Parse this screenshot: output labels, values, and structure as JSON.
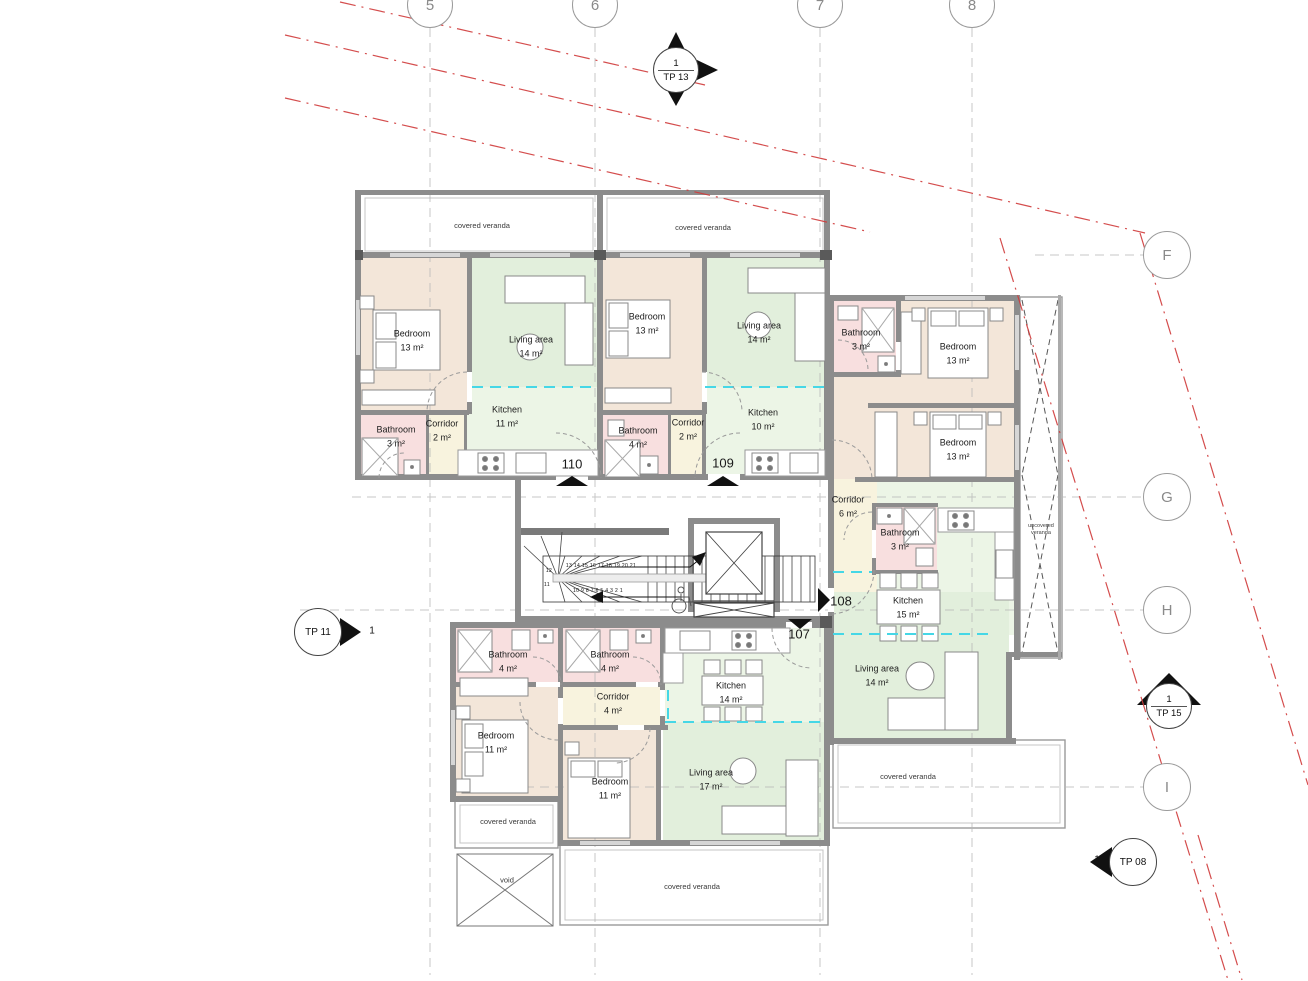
{
  "drawing": {
    "grid": {
      "columns": [
        "5",
        "6",
        "7",
        "8"
      ],
      "rows": [
        "F",
        "G",
        "H",
        "I"
      ]
    },
    "section_markers": {
      "tp13": {
        "number": "1",
        "label": "TP 13"
      },
      "tp11": {
        "number": "1",
        "label": "TP 11"
      },
      "tp15": {
        "number": "1",
        "label": "TP 15"
      },
      "tp08": {
        "number": "1",
        "label": "TP 08"
      }
    },
    "apartments": [
      {
        "number": "110",
        "rooms": [
          {
            "name": "Bedroom",
            "area": "13 m²"
          },
          {
            "name": "Living area",
            "area": "14 m²"
          },
          {
            "name": "Kitchen",
            "area": "11 m²"
          },
          {
            "name": "Bathroom",
            "area": "3 m²"
          },
          {
            "name": "Corridor",
            "area": "2 m²"
          }
        ]
      },
      {
        "number": "109",
        "rooms": [
          {
            "name": "Bedroom",
            "area": "13 m²"
          },
          {
            "name": "Living area",
            "area": "14 m²"
          },
          {
            "name": "Kitchen",
            "area": "10 m²"
          },
          {
            "name": "Bathroom",
            "area": "4 m²"
          },
          {
            "name": "Corridor",
            "area": "2 m²"
          }
        ]
      },
      {
        "number": "108",
        "rooms": [
          {
            "name": "Bathroom",
            "area": "3 m²"
          },
          {
            "name": "Bedroom",
            "area": "13 m²"
          },
          {
            "name": "Bedroom",
            "area": "13 m²"
          },
          {
            "name": "Corridor",
            "area": "6 m²"
          },
          {
            "name": "Bathroom",
            "area": "3 m²"
          },
          {
            "name": "Kitchen",
            "area": "15 m²"
          },
          {
            "name": "Living area",
            "area": "14 m²"
          }
        ]
      },
      {
        "number": "107",
        "rooms": [
          {
            "name": "Bathroom",
            "area": "4 m²"
          },
          {
            "name": "Bathroom",
            "area": "4 m²"
          },
          {
            "name": "Corridor",
            "area": "4 m²"
          },
          {
            "name": "Bedroom",
            "area": "11 m²"
          },
          {
            "name": "Bedroom",
            "area": "11 m²"
          },
          {
            "name": "Kitchen",
            "area": "14 m²"
          },
          {
            "name": "Living area",
            "area": "17 m²"
          }
        ]
      }
    ],
    "annotations": {
      "covered_veranda": "covered veranda",
      "uncovered_veranda": "uncovered veranda",
      "void": "void"
    },
    "stairs": {
      "upper_run": "13 14 15 16 17 18 19 20 21",
      "step_12": "12",
      "step_11": "11",
      "lower_run": "10 9 8 7 6 5 4 3 2 1"
    },
    "colors": {
      "bedroom": "#f3e6d9",
      "living": "#e2efdc",
      "kitchen": "#ecf5e6",
      "bathroom": "#f8dfdf",
      "corridor": "#f8f3de",
      "wall": "#8c8c8c",
      "boundary_red": "#d03a3a",
      "zone_cyan": "#45d7e6"
    }
  }
}
